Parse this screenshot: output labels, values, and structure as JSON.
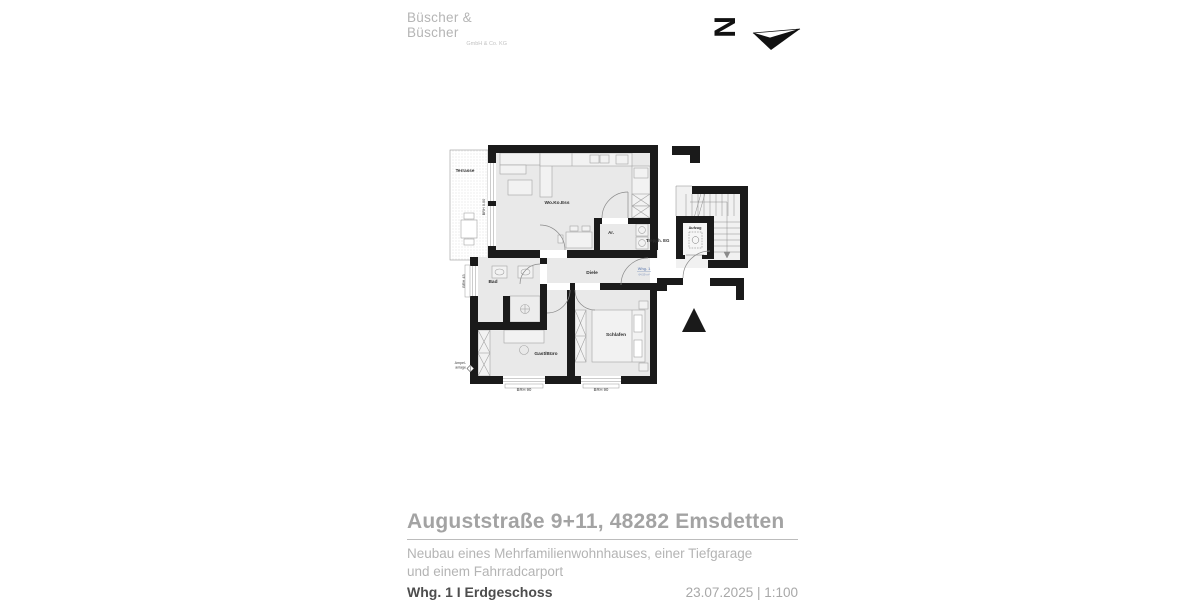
{
  "logo": {
    "name": "Büscher & Büscher",
    "suffix": "GmbH & Co. KG"
  },
  "compass": {
    "north_letter": "N"
  },
  "plan": {
    "rooms": {
      "terrasse": "Terrasse",
      "wokoess": "Wo.Ko.Ess",
      "abstell": "Ar.",
      "treppe": "Trepph. EG",
      "aufzug": "Aufzug",
      "diele": "Diele",
      "bad": "Bad",
      "gast": "Gast/Büro",
      "schlafen": "Schlafen"
    },
    "annotations": {
      "brh_terrasse": "BRH 0.00",
      "brh_bad": "BRH 45",
      "brh_window_left": "BRH 90",
      "brh_window_right": "BRH 90",
      "apartment": "Whg. 1",
      "apartment_area": "64.59 m²",
      "ampel_line1": "Ampel-",
      "ampel_line2": "anlage"
    }
  },
  "titleblock": {
    "title": "Auguststraße 9+11, 48282 Emsdetten",
    "project_line1": "Neubau eines Mehrfamilienwohnhauses, einer Tiefgarage",
    "project_line2": "und einem Fahrradcarport",
    "sheet": "Whg. 1 I Erdgeschoss",
    "date_scale": "23.07.2025 | 1:100"
  },
  "colors": {
    "wall": "#1a1a1a",
    "room_fill": "#e9e9e9",
    "accent_blue": "#8095bd",
    "title_gray": "#a3a3a3"
  }
}
